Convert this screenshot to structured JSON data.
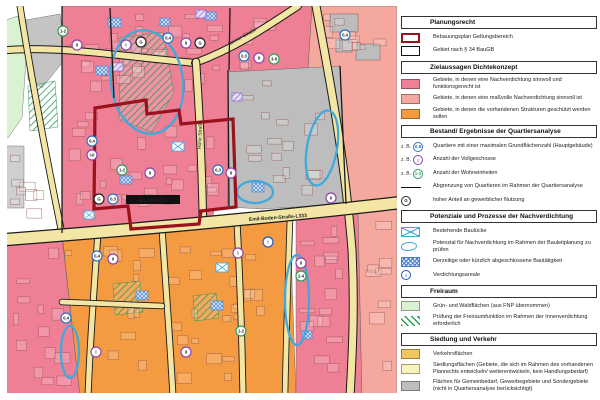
{
  "colors": {
    "zone_strong": "#ee7f95",
    "zone_moderate": "#f4a89e",
    "zone_protect": "#f49a40",
    "traffic": "#efc75e",
    "settlement": "#faf2bb",
    "special": "#bdbdbd",
    "green": "#d9f3d2",
    "blue": "#3fa9dc",
    "bplan_red": "#9b111e",
    "grz": "#2e6fc4",
    "floors": "#8e44ad",
    "units": "#2f9e57",
    "commercial": "#222222",
    "alert": "#2255cc"
  },
  "legend": {
    "example_prefix": "z. B.",
    "sections": [
      {
        "title": "Planungsrecht",
        "items": [
          {
            "swatch": "bplan",
            "label": "Bebauungsplan Geltungsbereich"
          },
          {
            "swatch": "par34",
            "label": "Gebiet nach § 34 BauGB"
          }
        ]
      },
      {
        "title": "Zielaussagen Dichtekonzept",
        "items": [
          {
            "swatch": "solid:zone_strong",
            "label": "Gebiete, in denen eine Nachverdichtung sinnvoll und funktionsgerecht ist"
          },
          {
            "swatch": "solid:zone_moderate",
            "label": "Gebiete, in denen eine maßvolle Nachverdichtung sinnvoll ist"
          },
          {
            "swatch": "solid:zone_protect",
            "label": "Gebiete, in denen die vorhandenen Strukturen geschützt werden sollen"
          }
        ]
      },
      {
        "title": "Bestand/ Ergebnisse der Quartiersanalyse",
        "items": [
          {
            "swatch": "badge:grz:0,8",
            "prefix": "z. B.",
            "label": "Quartiere mit einer maximalen Grundflächenzahl (Hauptgebäude)"
          },
          {
            "swatch": "badge:floors:I",
            "prefix": "z. B.",
            "label": "Anzahl der Vollgeschosse"
          },
          {
            "swatch": "badge:units:1-2",
            "prefix": "z. B.",
            "label": "Anzahl der Wohneinheiten"
          },
          {
            "swatch": "line",
            "label": "Abgrenzung von Quartieren im Rahmen der Quartiersanalyse"
          },
          {
            "swatch": "badge:commercial:G",
            "label": "hoher Anteil an gewerblicher Nutzung"
          }
        ]
      },
      {
        "title": "Potenziale und Prozesse der Nachverdichtung",
        "items": [
          {
            "swatch": "xrect",
            "label": "Bestehende Baulücke"
          },
          {
            "swatch": "blob",
            "label": "Potenzial für Nachverdichtung im Rahmen der Bauleitplanung zu prüfen"
          },
          {
            "swatch": "hatchblue",
            "label": "Derzeitige oder kürzlich abgeschlossene Bautätigkeit"
          },
          {
            "swatch": "badge:alert:!",
            "label": "Verdichtungsareale"
          }
        ]
      },
      {
        "title": "Freiraum",
        "items": [
          {
            "swatch": "solid:green",
            "label": "Grün- und Waldflächen (aus FNP übernommen)"
          },
          {
            "swatch": "hatchgreen",
            "label": "Prüfung der Freiraumfunktion im Rahmen der Innenverdichtung erforderlich"
          }
        ]
      },
      {
        "title": "Siedlung und Verkehr",
        "items": [
          {
            "swatch": "solid:traffic",
            "label": "Verkehrsflächen"
          },
          {
            "swatch": "solid:settlement",
            "label": "Siedlungsflächen (Gebiete, die sich im Rahmen des vorhandenen Planrechts entwickeln/ weiterentwickeln, kein Handlungsbedarf)"
          },
          {
            "swatch": "solid:special",
            "label": "Flächen für Gemeinbedarf, Gewerbegebiete und Sondergebiete (nicht in Quartiersanalyse berücksichtigt)"
          }
        ]
      }
    ]
  },
  "map": {
    "street_labels": {
      "top": "Berner Straße",
      "vertical": "Hohe Straße",
      "main": "Emil-Boden-Straße-L333",
      "banner": "Hauptstraße"
    },
    "badges": [
      {
        "x": 63,
        "y": 31,
        "k": "units",
        "t": "1-2"
      },
      {
        "x": 77,
        "y": 45,
        "k": "floors",
        "t": "II"
      },
      {
        "x": 126,
        "y": 45,
        "k": "floors",
        "t": "I"
      },
      {
        "x": 141,
        "y": 42,
        "k": "commercial",
        "t": "G"
      },
      {
        "x": 168,
        "y": 38,
        "k": "grz",
        "t": "0,4"
      },
      {
        "x": 186,
        "y": 43,
        "k": "floors",
        "t": "II"
      },
      {
        "x": 200,
        "y": 43,
        "k": "commercial",
        "t": "G"
      },
      {
        "x": 244,
        "y": 56,
        "k": "grz",
        "t": "0,3"
      },
      {
        "x": 259,
        "y": 58,
        "k": "floors",
        "t": "II"
      },
      {
        "x": 274,
        "y": 59,
        "k": "units",
        "t": "3-6"
      },
      {
        "x": 345,
        "y": 35,
        "k": "grz",
        "t": "0,4"
      },
      {
        "x": 92,
        "y": 141,
        "k": "grz",
        "t": "0,4"
      },
      {
        "x": 92,
        "y": 155,
        "k": "floors",
        "t": "I-II"
      },
      {
        "x": 122,
        "y": 170,
        "k": "units",
        "t": "1-2"
      },
      {
        "x": 150,
        "y": 173,
        "k": "floors",
        "t": "II"
      },
      {
        "x": 218,
        "y": 170,
        "k": "grz",
        "t": "0,3"
      },
      {
        "x": 231,
        "y": 173,
        "k": "floors",
        "t": "II"
      },
      {
        "x": 331,
        "y": 198,
        "k": "floors",
        "t": "II"
      },
      {
        "x": 99,
        "y": 199,
        "k": "commercial",
        "t": "G"
      },
      {
        "x": 113,
        "y": 199,
        "k": "grz",
        "t": "0,3"
      },
      {
        "x": 97,
        "y": 256,
        "k": "grz",
        "t": "0,4"
      },
      {
        "x": 113,
        "y": 259,
        "k": "floors",
        "t": "II"
      },
      {
        "x": 238,
        "y": 253,
        "k": "floors",
        "t": "I"
      },
      {
        "x": 268,
        "y": 242,
        "k": "alert",
        "t": "!"
      },
      {
        "x": 301,
        "y": 263,
        "k": "floors",
        "t": "II"
      },
      {
        "x": 301,
        "y": 276,
        "k": "units",
        "t": "2-4"
      },
      {
        "x": 66,
        "y": 318,
        "k": "grz",
        "t": "0,4"
      },
      {
        "x": 96,
        "y": 352,
        "k": "floors",
        "t": "I"
      },
      {
        "x": 186,
        "y": 352,
        "k": "floors",
        "t": "II"
      },
      {
        "x": 241,
        "y": 331,
        "k": "units",
        "t": "1-2"
      }
    ]
  }
}
